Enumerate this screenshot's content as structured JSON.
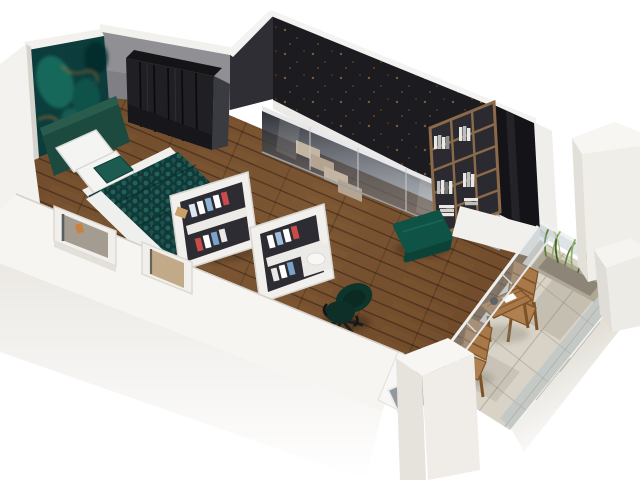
{
  "scene": {
    "title": "3D isometric cutaway floor-plan render of a studio apartment with bedroom, living area, staircase with glass balustrade and a furnished balcony",
    "width": 640,
    "height": 480,
    "background": "#ffffff"
  },
  "rooms": [
    {
      "name": "bedroom",
      "furniture": [
        "teal-gold-mural-accent-wall",
        "black-wardrobe",
        "double-bed-with-teal-patterned-duvet",
        "white-pillows",
        "green-upholstered-headboard",
        "window-recess"
      ]
    },
    {
      "name": "living-area",
      "furniture": [
        "black-speckled-accent-wall",
        "staircase-with-glass-balustrade",
        "open-top-storage-unit-a",
        "open-top-storage-unit-b",
        "cube-bookshelf-with-books",
        "glossy-dark-wall-panel",
        "teal-floor-pouf",
        "dark-green-desk-chair",
        "dark-walnut-plank-floor"
      ]
    },
    {
      "name": "balcony",
      "furniture": [
        "stone-tile-floor",
        "glass-partition",
        "glass-railing",
        "planter-with-ornamental-grasses",
        "wooden-folding-table",
        "wooden-folding-chair-upper",
        "wooden-folding-chair-lower"
      ]
    },
    {
      "name": "exterior",
      "furniture": [
        "white-cutaway-walls",
        "white-pillar-top-right",
        "white-block-right-edge",
        "white-pillar-bottom-center",
        "glass-door"
      ]
    }
  ],
  "colors": {
    "wall_white": "#f6f5f2",
    "wall_cap": "#f2f1ee",
    "wall_face": "#eceae5",
    "wall_shade": "#dcd8d2",
    "wall_gray": "#8f8f94",
    "wall_gray_dark": "#77777d",
    "wardrobe": "#1f1f24",
    "wardrobe_top": "#141417",
    "accent_black": "#1c1b20",
    "accent_side": "#2e2e34",
    "gold_dot": "#8a6030",
    "mural_base": "#0c3c3b",
    "mural_teal": "#177062",
    "mural_gold": "#9a6c33",
    "headboard": "#1d4a3e",
    "duvet": "#10393a",
    "duvet_dot": "#27695d",
    "pillow": "#f4f4f2",
    "wood": "#74512f",
    "wood_hi": "#8a6138",
    "wood_line": "#3c2613",
    "gloss": "#141318",
    "shelf_wood": "#8a6a48",
    "book_light": "#e9e9e7",
    "book_mid": "#bdbdbb",
    "pouf": "#0f5347",
    "chair": "#0e352c",
    "stone": "#d8d3c6",
    "stone_dark": "#cbc5b7",
    "planter": "#b0a897",
    "grass": "#5d8038",
    "grass_light": "#8fae62",
    "grass_dark": "#3f632a",
    "bal_wood": "#a87848",
    "bal_wood_dark": "#7c5226",
    "step": "#b9aa96",
    "orange_item": "#c8823e"
  }
}
